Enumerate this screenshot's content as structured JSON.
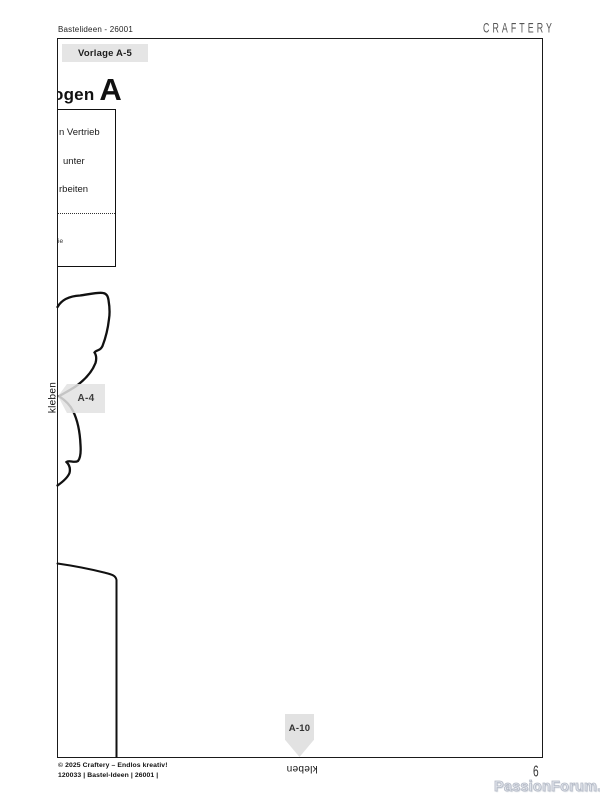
{
  "page": {
    "doc_ref": "Bastelideen - 26001",
    "brand": "CRAFTERY",
    "page_number": "6",
    "watermark": "PassionForum.ru"
  },
  "sheet": {
    "tag": "Vorlage A-5",
    "heading_fragment": "ogen",
    "heading_letter": "A",
    "info_box": {
      "line1": "n Vertrieb",
      "line2": "unter",
      "line3": "rbeiten",
      "small_line": "ie"
    },
    "labels": {
      "a4": "A-4",
      "a10": "A-10",
      "glue_left": "kleben",
      "glue_bottom": "kleben"
    }
  },
  "footer": {
    "copyright": "© 2025 Craftery – Endlos kreativ!",
    "code_line": "120033 | Bastel-Ideen | 26001 |"
  },
  "colors": {
    "label_bg": "#e4e4e4",
    "outline": "#111111"
  }
}
